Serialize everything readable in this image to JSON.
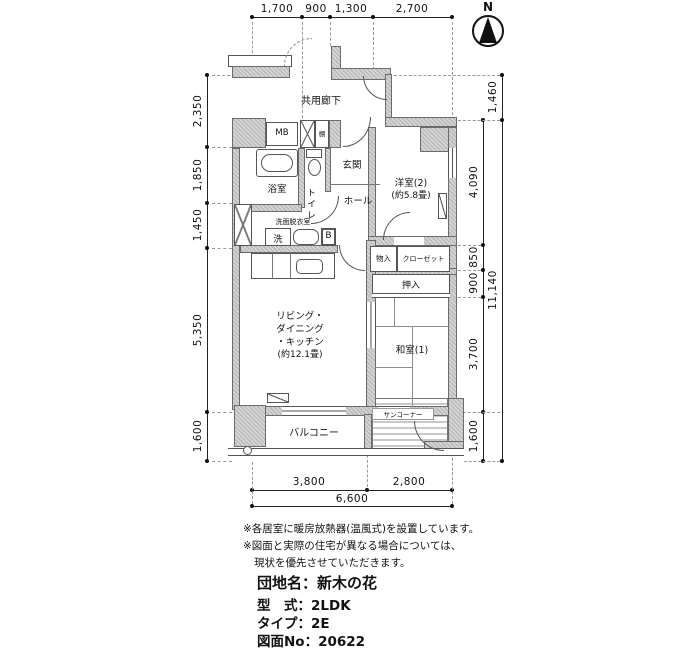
{
  "compass": {
    "north": "N"
  },
  "dims": {
    "top": [
      "1,700",
      "900",
      "1,300",
      "2,700"
    ],
    "left": [
      "2,350",
      "1,850",
      "1,450",
      "5,350",
      "1,600"
    ],
    "right_outer": [
      "1,460",
      "11,140"
    ],
    "right_inner": [
      "4,090",
      "850",
      "900",
      "3,700",
      "1,600"
    ],
    "bottom": [
      "3,800",
      "2,800"
    ],
    "bottom_total": "6,600"
  },
  "rooms": {
    "corridor": "共用廊下",
    "entrance": "玄関",
    "hall": "ホール",
    "toilet": "トイレ",
    "bath": "浴室",
    "washroom": "洗面脱衣室",
    "western2": "洋室(2)",
    "western2_size": "(約5.8畳)",
    "ldk_line1": "リビング・",
    "ldk_line2": "ダイニング",
    "ldk_line3": "・キッチン",
    "ldk_size": "(約12.1畳)",
    "japanese1": "和室(1)",
    "oshiire": "押入",
    "storage": "物入",
    "closet": "クローゼット",
    "balcony": "バルコニー",
    "sun_corner": "サンコーナー"
  },
  "fixtures": {
    "meter_box": "MB",
    "shelf": "棚",
    "washer": "洗",
    "boiler": "B"
  },
  "notes": [
    "※各居室に暖房放熱器(温風式)を設置しています。",
    "※図面と実際の住宅が異なる場合については、",
    "現状を優先させていただきます。"
  ],
  "info": {
    "estate": "団地名：新木の花",
    "layout": "型　式：2LDK",
    "type": "タイプ：2E",
    "drawing_no": "図面No：20622"
  }
}
